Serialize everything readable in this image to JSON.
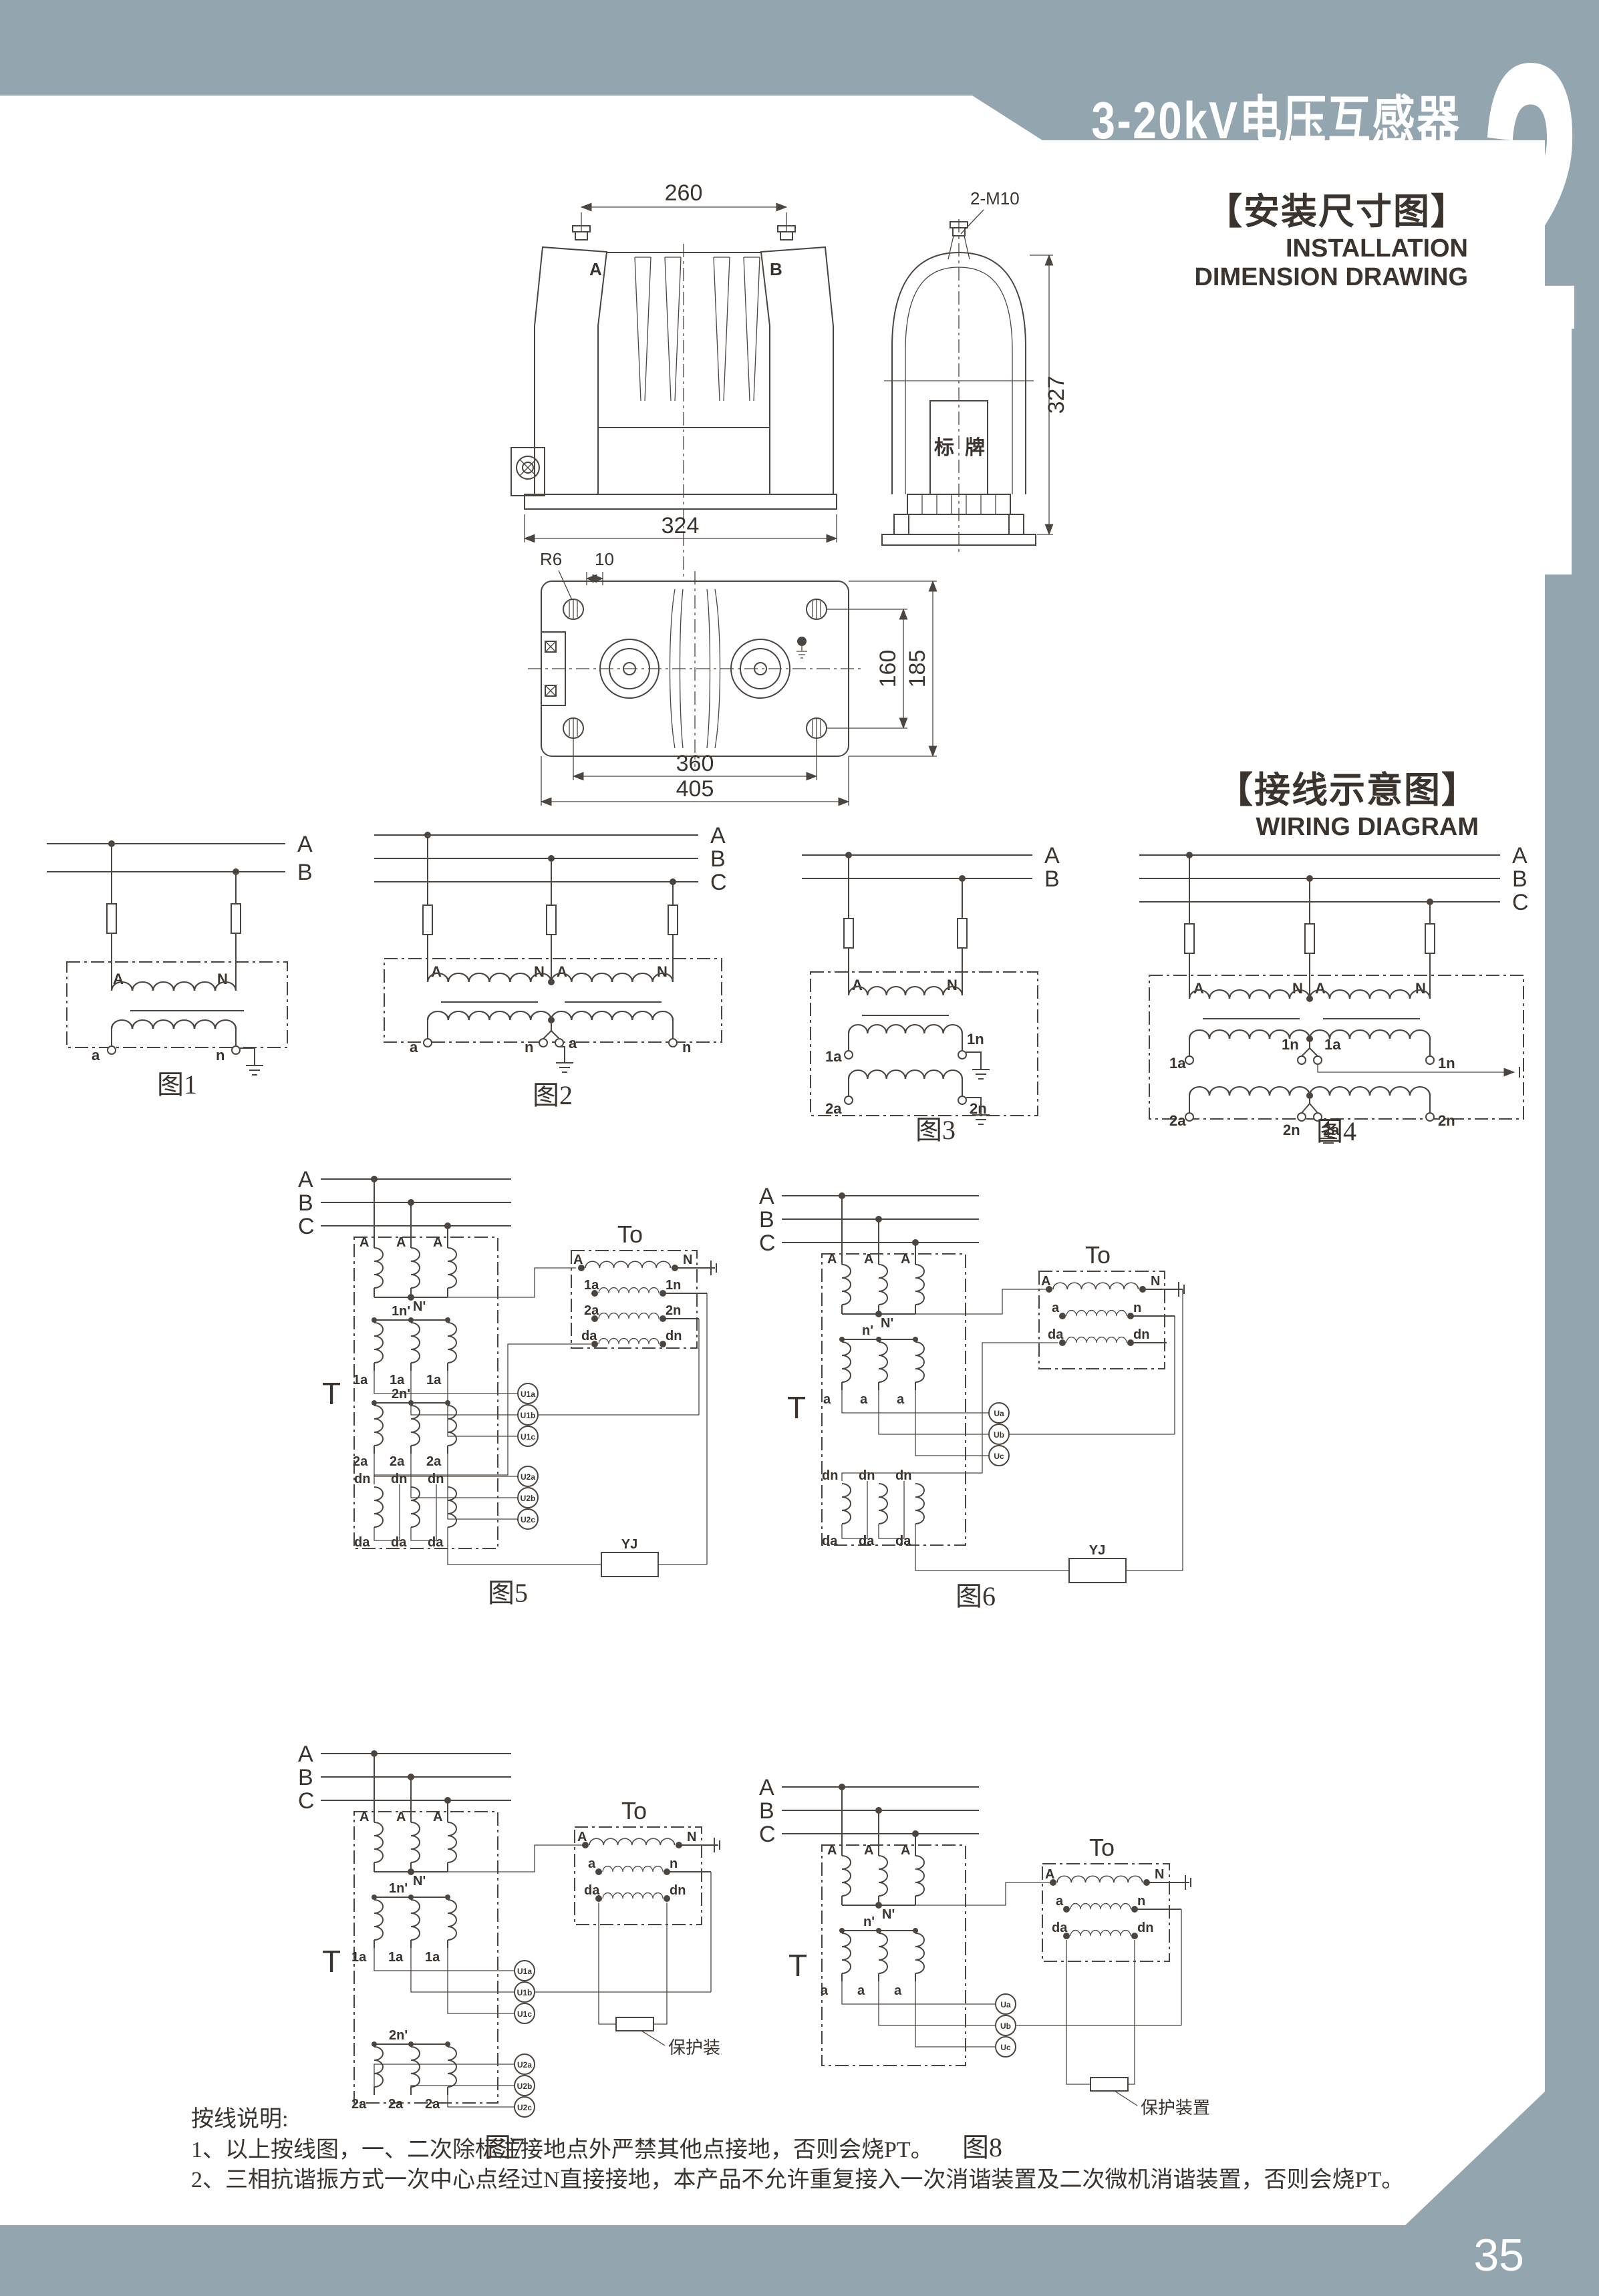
{
  "page": {
    "title": "3-20kV电压互感器",
    "chapter_number": "2",
    "number": "35"
  },
  "colors": {
    "accent_gray": "#93a6b0",
    "ink": "#3b332e",
    "line": "#4c443f"
  },
  "headings": {
    "installation_zh": "【安装尺寸图】",
    "installation_en1": "INSTALLATION",
    "installation_en2": "DIMENSION DRAWING",
    "wiring_zh": "【接线示意图】",
    "wiring_en": "WIRING DIAGRAM"
  },
  "installation": {
    "front": {
      "dim_top": "260",
      "terminal_left": "A",
      "terminal_right": "B",
      "dim_bottom": "324"
    },
    "side": {
      "bolt": "2-M10",
      "nameplate": "标牌",
      "dim_height": "327"
    },
    "plan": {
      "radius": "R6",
      "slot": "10",
      "dim_inner": "360",
      "dim_outer": "405",
      "dim_hole_span": "160",
      "dim_depth": "185"
    }
  },
  "figures": {
    "fig1": {
      "caption": "图1",
      "bus": [
        "A",
        "B"
      ],
      "primary": [
        "A",
        "N"
      ],
      "secondary": [
        "a",
        "n"
      ]
    },
    "fig2": {
      "caption": "图2",
      "bus": [
        "A",
        "B",
        "C"
      ],
      "primary": [
        "A",
        "N",
        "A",
        "N"
      ],
      "secondary": [
        "a",
        "n",
        "a",
        "n"
      ]
    },
    "fig3": {
      "caption": "图3",
      "bus": [
        "A",
        "B"
      ],
      "primary": [
        "A",
        "N"
      ],
      "secondary1": [
        "1a",
        "1n"
      ],
      "secondary2": [
        "2a",
        "2n"
      ]
    },
    "fig4": {
      "caption": "图4",
      "bus": [
        "A",
        "B",
        "C"
      ],
      "primary": [
        "A",
        "N",
        "A",
        "N"
      ],
      "secondary1": [
        "1a",
        "1n",
        "1a",
        "1n"
      ],
      "secondary2": [
        "2a",
        "2n",
        "2a",
        "2n"
      ]
    },
    "fig5": {
      "caption": "图5",
      "t": "T",
      "t0": "To",
      "bus": [
        "A",
        "B",
        "C"
      ],
      "row1_top": [
        "A",
        "A",
        "A"
      ],
      "row1_n": "N'",
      "row2_n": "1n'",
      "row2": [
        "1a",
        "1a",
        "1a"
      ],
      "row3_n": "2n'",
      "row3": [
        "2a",
        "2a",
        "2a"
      ],
      "row4_top": [
        "dn",
        "dn",
        "dn"
      ],
      "row4_bot": [
        "da",
        "da",
        "da"
      ],
      "m1": [
        "U1a",
        "U1b",
        "U1c"
      ],
      "m2": [
        "U2a",
        "U2b",
        "U2c"
      ],
      "w1": [
        "A",
        "N"
      ],
      "w2": [
        "1a",
        "1n"
      ],
      "w3": [
        "2a",
        "2n"
      ],
      "w4": [
        "da",
        "dn"
      ],
      "relay": "YJ"
    },
    "fig6": {
      "caption": "图6",
      "t": "T",
      "t0": "To",
      "bus": [
        "A",
        "B",
        "C"
      ],
      "row1_top": [
        "A",
        "A",
        "A"
      ],
      "row1_n": "N'",
      "row2_n": "n'",
      "row2": [
        "a",
        "a",
        "a"
      ],
      "row3_top": [
        "dn",
        "dn",
        "dn"
      ],
      "row3_bot": [
        "da",
        "da",
        "da"
      ],
      "m": [
        "Ua",
        "Ub",
        "Uc"
      ],
      "w1": [
        "A",
        "N"
      ],
      "w2": [
        "a",
        "n"
      ],
      "w3": [
        "da",
        "dn"
      ],
      "relay": "YJ"
    },
    "fig7": {
      "caption": "图7",
      "t": "T",
      "t0": "To",
      "bus": [
        "A",
        "B",
        "C"
      ],
      "row1_top": [
        "A",
        "A",
        "A"
      ],
      "row1_n": "N'",
      "row2_n": "1n'",
      "row2": [
        "1a",
        "1a",
        "1a"
      ],
      "row3_n": "2n'",
      "row3": [
        "2a",
        "2a",
        "2a"
      ],
      "m1": [
        "U1a",
        "U1b",
        "U1c"
      ],
      "m2": [
        "U2a",
        "U2b",
        "U2c"
      ],
      "w1": [
        "A",
        "N"
      ],
      "w2": [
        "a",
        "n"
      ],
      "w3": [
        "da",
        "dn"
      ],
      "protection": "保护装置"
    },
    "fig8": {
      "caption": "图8",
      "t": "T",
      "t0": "To",
      "bus": [
        "A",
        "B",
        "C"
      ],
      "row1_top": [
        "A",
        "A",
        "A"
      ],
      "row1_n": "N'",
      "row2_n": "n'",
      "row2": [
        "a",
        "a",
        "a"
      ],
      "m": [
        "Ua",
        "Ub",
        "Uc"
      ],
      "w1": [
        "A",
        "N"
      ],
      "w2": [
        "a",
        "n"
      ],
      "w3": [
        "da",
        "dn"
      ],
      "protection": "保护装置"
    }
  },
  "notes": {
    "title": "按线说明:",
    "items": [
      "1、以上按线图，一、二次除标注接地点外严禁其他点接地，否则会烧PT。",
      "2、三相抗谐振方式一次中心点经过N直接接地，本产品不允许重复接入一次消谐装置及二次微机消谐装置，否则会烧PT。"
    ]
  }
}
